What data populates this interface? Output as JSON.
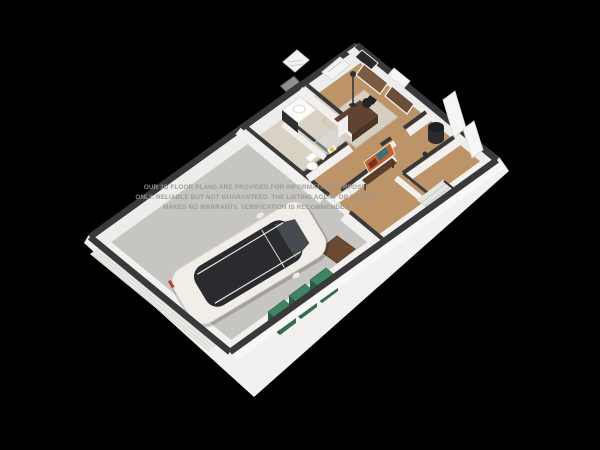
{
  "scene": {
    "description": "3D isometric floor plan render on black background with garage, car, bins and furnished rooms",
    "watermark": {
      "line1": "OUR 3D FLOOR PLANS ARE PROVIDED FOR INFORMATION PURPOSES",
      "line2": "ONLY. RELIABLE BUT NOT GUARANTEED. THE LISTING AGENT OR BROKER",
      "line3": "MAKES NO WARRANTY. VERIFICATION IS RECOMMENDED."
    },
    "colors": {
      "background": "#000000",
      "base_white": "#f2f1ef",
      "wall_face": "#ededeb",
      "wall_front": "#f8f7f5",
      "wall_cap": "#39393b",
      "garage_floor": "#c6c5c1",
      "wood_floor": "#bd9468",
      "tile_floor": "#d9d1c3",
      "rug": "#d6cfc0",
      "garage_door": "#eceae7",
      "car_body": "#f0eee7",
      "car_glass": "#2a2b2e",
      "bin_top": "#3f8564",
      "doormat": "#6b4c33",
      "stairs": "#e4e6e0",
      "desk_wood": "#5f4330",
      "bench_wood": "#5a3d2b",
      "artwork_warm": "#c2622c",
      "artwork_teal": "#3f6f7a",
      "artwork_dark": "#7c2d1e",
      "watermark": "#9b9894"
    }
  }
}
